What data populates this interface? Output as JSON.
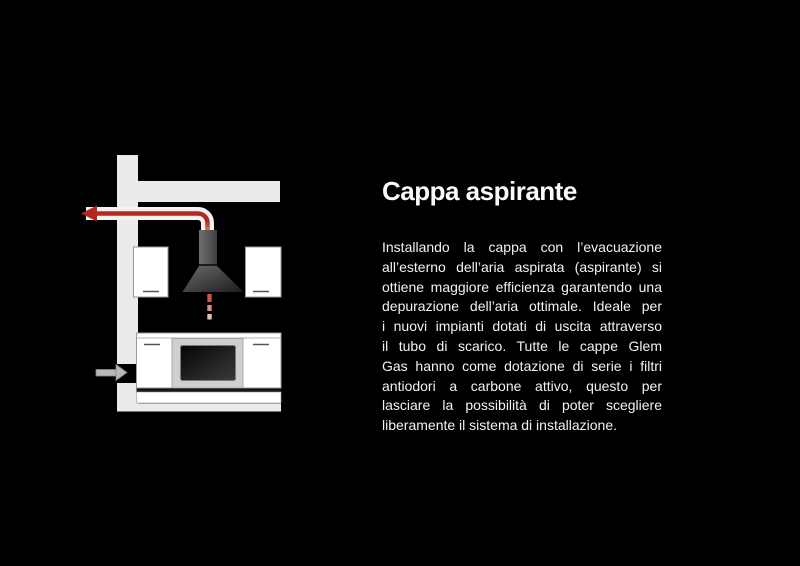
{
  "article": {
    "title": "Cappa aspirante",
    "lines": [
      "Installando la cappa con l’evacuazione",
      "all’esterno dell’aria aspirata (aspirante) si",
      "ottiene maggiore efficienza garantendo una",
      "depurazione dell’aria ottimale. Ideale per",
      "i nuovi impianti dotati di uscita attraverso",
      "il tubo di scarico. Tutte le cappe Glem",
      "Gas hanno come dotazione di serie i filtri",
      "antiodori a carbone attivo, questo per",
      "lasciare la possibilità di poter scegliere",
      "liberamente il sistema di installazione."
    ]
  },
  "diagram": {
    "description": "kitchen-hood-external-air-evacuation-diagram",
    "parts": [
      "wall",
      "ceiling-soffit",
      "exhaust-duct-tube",
      "exhaust-air-arrow",
      "hood-chimney",
      "hood-canopy",
      "rising-air-dashes",
      "wall-cabinet-left",
      "wall-cabinet-right",
      "base-cabinets",
      "oven",
      "plinth",
      "floor",
      "air-inlet-arrow",
      "wall-inlet-gap"
    ]
  },
  "colors": {
    "bg": "#000000",
    "title": "#fafafa",
    "text": "#f2f2f2",
    "structure": "#ebebeb",
    "cabinet": "#ffffff",
    "cabinet-border": "#9a9a9a",
    "handle": "#555555",
    "tube": "#f2f2f2",
    "duct-red": "#b2281e",
    "duct-salmon": "#efb4a4",
    "hood-a": "#6a6a6a",
    "hood-b": "#1c1c1c",
    "chim-a": "#707070",
    "chim-b": "#3f3f3f",
    "glass-a": "#050505",
    "glass-b": "#3a3a3a",
    "oven-frame": "#cfcfcf",
    "dash-1": "#c85848",
    "dash-2": "#d89084",
    "dash-3": "#e7c0b4",
    "inlet": "#b8b8b8",
    "inlet-border": "#858585",
    "shadow": "#151515"
  }
}
